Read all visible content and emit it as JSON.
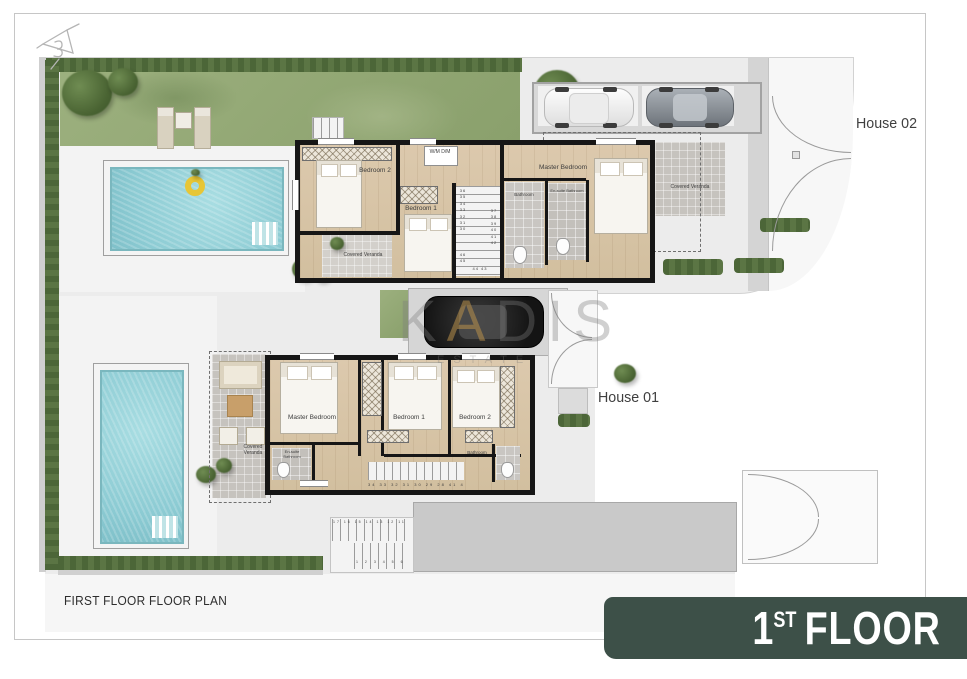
{
  "plan": {
    "caption": "FIRST FLOOR FLOOR PLAN",
    "banner": {
      "number": "1",
      "suffix": "ST",
      "word": "FLOOR"
    },
    "house02": {
      "label": "House 02",
      "rooms": {
        "bedroom2": "Bedroom 2",
        "bedroom1": "Bedroom 1",
        "master": "Master Bedroom",
        "bathroom": "Bathroom",
        "ensuite": "En-suite Bathroom",
        "laundry": "W/M D/M",
        "veranda_bottom": "Covered Veranda",
        "veranda_right": "Covered Veranda"
      },
      "stairs": {
        "left_run": "36 35 34 33 32 31 30",
        "right_run": "37 38 39 40 41 42",
        "bottom_run": "44 43",
        "landing": "46 45"
      }
    },
    "house01": {
      "label": "House 01",
      "rooms": {
        "master": "Master Bedroom",
        "bedroom1": "Bedroom 1",
        "bedroom2": "Bedroom 2",
        "bathroom": "Bathroom",
        "ensuite": "En-suite Bathroom",
        "veranda": "Covered Veranda"
      },
      "stairs": {
        "interior": "34 33 32 31 30 29 28 41 40 39 38",
        "exterior_upper": "17 16 15 14 13 12 11 10 9 8",
        "exterior_lower": "1 2 3 4 5 6 7"
      }
    },
    "watermark": {
      "part1": "K",
      "part2": "A",
      "part3": "DIS",
      "line2": "ESTATE"
    },
    "colors": {
      "banner": "#3d5048",
      "pool_water": "#8fced6",
      "grass": "#95aa79",
      "hedge": "#4f6a3c",
      "wall": "#161616",
      "wood_floor": "#d8c5a8",
      "watermark_gold": "#c2a068"
    }
  }
}
